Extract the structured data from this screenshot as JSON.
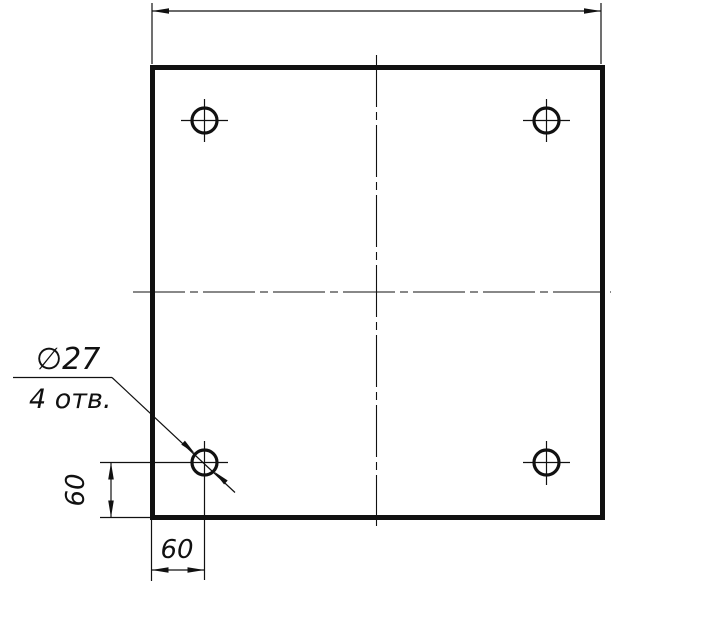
{
  "drawing": {
    "title": "square-plate-with-four-holes",
    "background_color": "#ffffff",
    "line_color": "#111111",
    "callout": {
      "diameter_label": "∅27",
      "count_label": "4 отв."
    },
    "dimensions": {
      "left_vertical_label": "60",
      "bottom_horizontal_label": "60"
    },
    "holes_visible": 4
  }
}
